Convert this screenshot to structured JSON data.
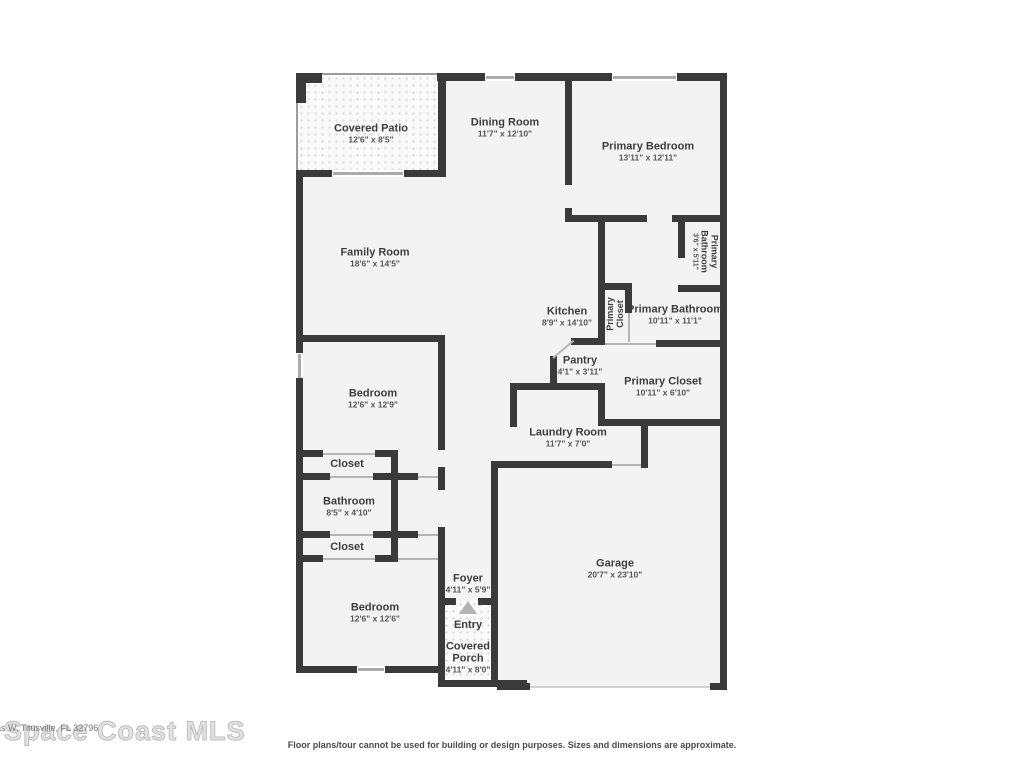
{
  "watermark": {
    "brand": "Space Coast MLS",
    "address_fragment": "as W, Titusville, FL 32796"
  },
  "disclaimer": "Floor plans/tour cannot be used for building or design purposes. Sizes and dimensions are approximate.",
  "colors": {
    "wall": "#3a3a3a",
    "room_fill": "#f3f3f3",
    "label_text": "#3d3d3d"
  },
  "rooms": [
    {
      "name": "Covered Patio",
      "dims": "12'6\" x 8'5\""
    },
    {
      "name": "Dining Room",
      "dims": "11'7\" x 12'10\""
    },
    {
      "name": "Primary Bedroom",
      "dims": "13'11\" x 12'11\""
    },
    {
      "name": "Family Room",
      "dims": "18'6\" x 14'5\""
    },
    {
      "name": "Primary Bathroom",
      "dims": "3'6\" x 5'11\""
    },
    {
      "name": "Kitchen",
      "dims": "8'9\" x 14'10\""
    },
    {
      "name": "Primary Closet",
      "dims": ""
    },
    {
      "name": "Primary Bathroom",
      "dims": "10'11\" x 11'1\""
    },
    {
      "name": "Pantry",
      "dims": "4'1\" x 3'11\""
    },
    {
      "name": "Primary Closet",
      "dims": "10'11\" x 6'10\""
    },
    {
      "name": "Bedroom",
      "dims": "12'6\" x 12'9\""
    },
    {
      "name": "Closet",
      "dims": ""
    },
    {
      "name": "Bathroom",
      "dims": "8'5\" x 4'10\""
    },
    {
      "name": "Closet",
      "dims": ""
    },
    {
      "name": "Laundry Room",
      "dims": "11'7\" x 7'0\""
    },
    {
      "name": "Bedroom",
      "dims": "12'6\" x 12'6\""
    },
    {
      "name": "Foyer",
      "dims": "4'11\" x 5'9\""
    },
    {
      "name": "Entry",
      "dims": ""
    },
    {
      "name": "Covered Porch",
      "dims": "4'11\" x 8'0\""
    },
    {
      "name": "Garage",
      "dims": "20'7\" x 23'10\""
    }
  ]
}
